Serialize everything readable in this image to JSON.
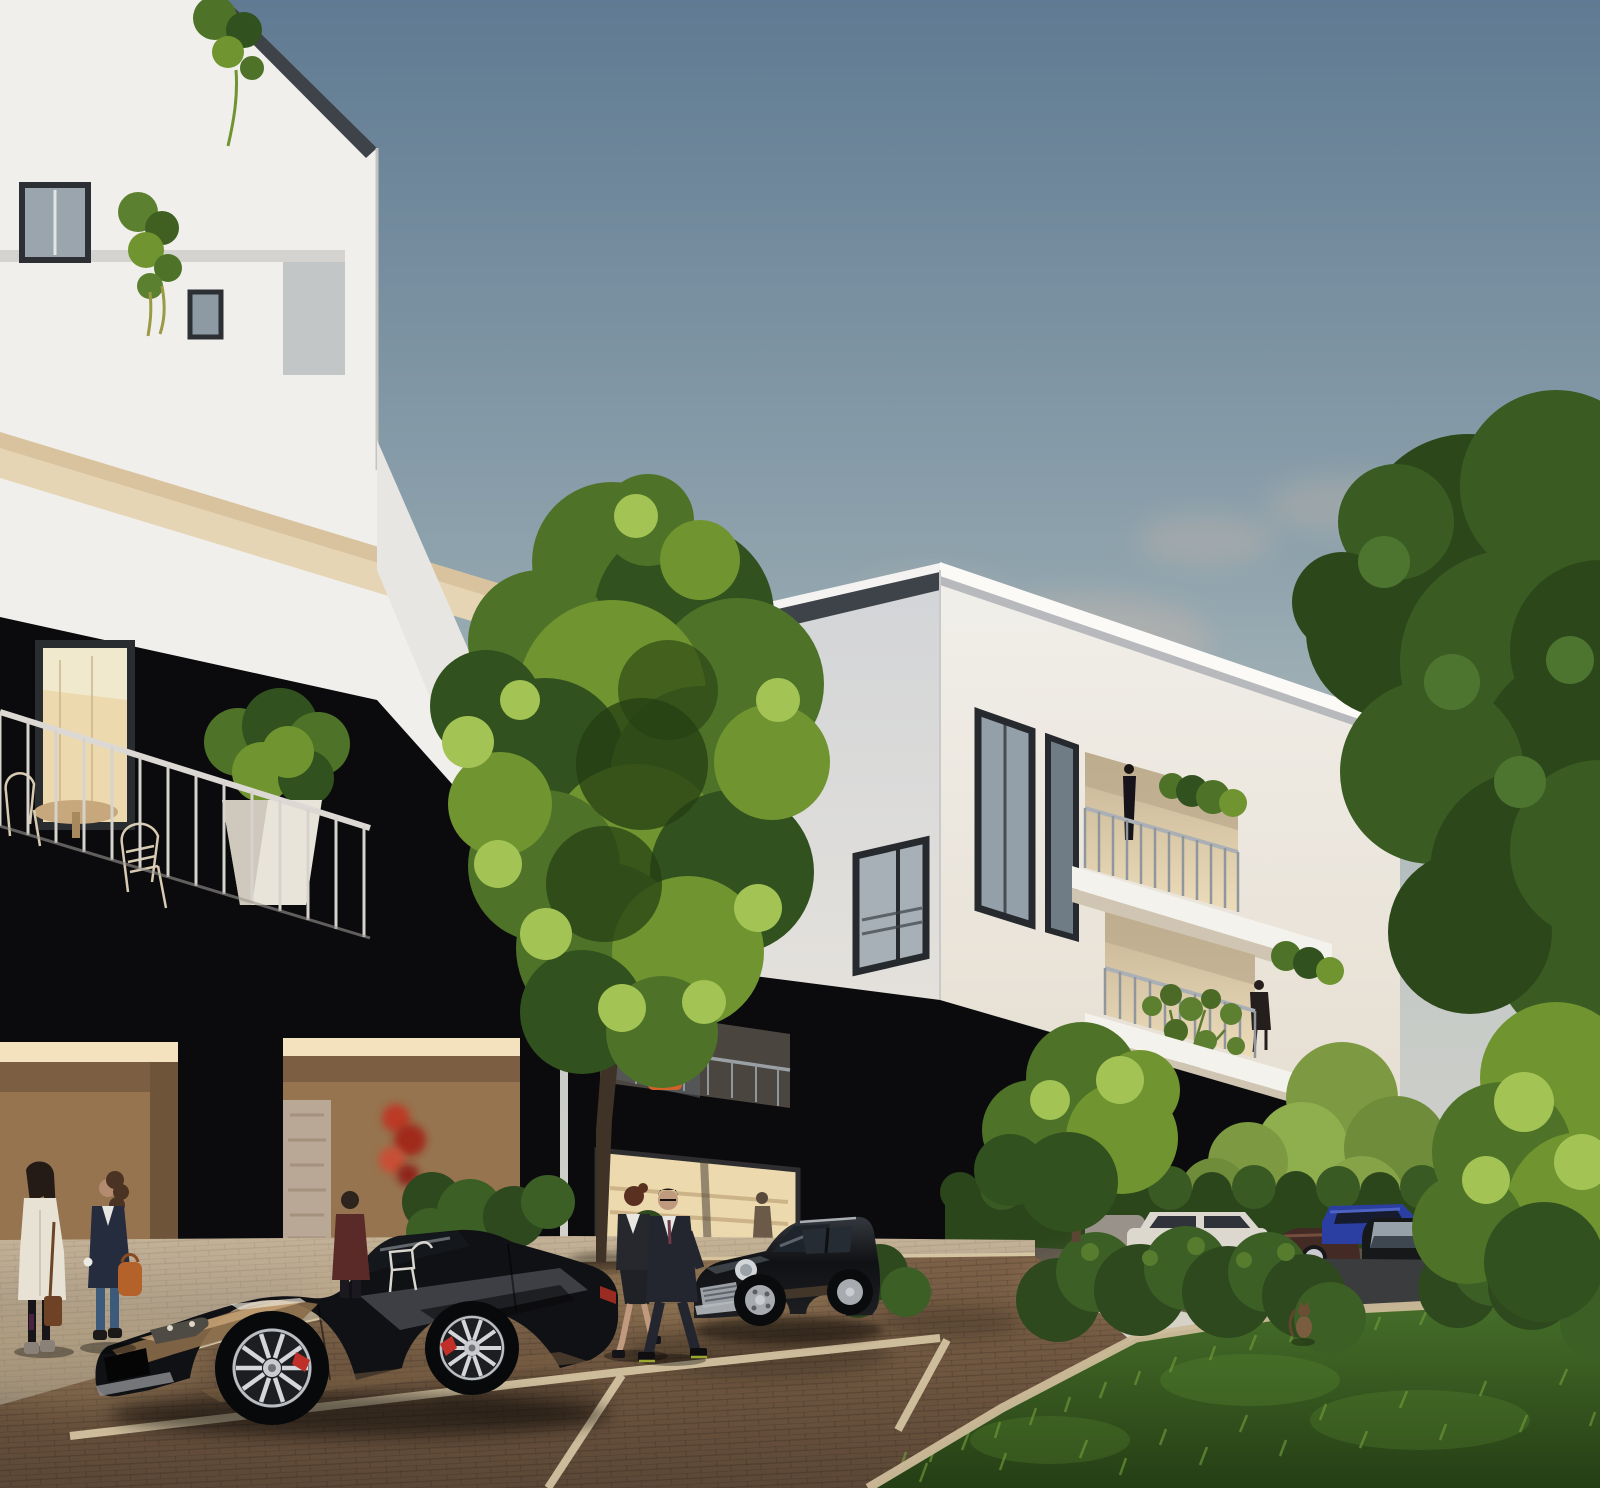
{
  "scene": {
    "title": "Architectural rendering of a modern black-and-white apartment complex at dusk, street view with parked cars, pedestrians, trees and warm-lit ground-floor shops",
    "time_of_day": "dusk",
    "style": "photorealistic CGI visualization"
  },
  "palette": {
    "sky_top": "#5f7a92",
    "sky_mid": "#8fa3ad",
    "sky_low": "#c7cbc7",
    "sky_horizon": "#ddd6cd",
    "cloud": "#cbb8ab",
    "facade_white": "#f0efec",
    "facade_white_shaded": "#d6d8da",
    "facade_black": "#0b0b0d",
    "roof_trim": "#3e434a",
    "soffit_cream": "#e6d5b4",
    "window_frame": "#26292d",
    "glass_cool": "#93a0a9",
    "glass_dark": "#2d343c",
    "interior_warm": "#ecd9ae",
    "portal_tan": "#96744f",
    "portal_tan_dark": "#6e5439",
    "accent_red_plant": "#c03524",
    "accent_orange_chair": "#d2622a",
    "railing_light": "#d6d3cd",
    "tree_dark": "#31511e",
    "tree_mid": "#4e7328",
    "tree_light": "#70942f",
    "tree_highlight": "#a3c355",
    "hedge": "#2c461c",
    "grass_dark": "#253e15",
    "grass_light": "#47702a",
    "road_brown": "#6e5640",
    "sidewalk": "#b3a38c",
    "marking_cream": "#d9c9a6",
    "asphalt": "#3a3c3d",
    "car_black": "#101114",
    "car_white": "#dcd8cf",
    "car_blue": "#2b3fa3",
    "car_maroon": "#432a24",
    "chrome": "#c9cbd0",
    "caliper_red": "#c03028",
    "skin": "#c09a7e",
    "coat_cream": "#e7e2d4",
    "jacket_navy": "#252c3e",
    "suit_dark": "#23252f",
    "jacket_maroon": "#5a2a28",
    "bag_orange": "#b5622a",
    "jeans_blue": "#3c5a7c",
    "cat_brown": "#7a5c3e"
  },
  "objects": [
    {
      "id": "building-left",
      "label": "white multi-storey apartment building in left foreground with black lower facade and recessed balconies"
    },
    {
      "id": "building-center",
      "label": "white corner apartment block with black ground floor and stacked corner balconies with planters"
    },
    {
      "id": "terrace-balcony",
      "label": "first-floor terrace with white railing, wire chairs, round table and potted shrub"
    },
    {
      "id": "entrance-portals",
      "label": "warm-lit recessed tan entrance portals with illuminated red plant"
    },
    {
      "id": "shop-window",
      "label": "warm-lit retail window with shelving and a browsing woman"
    },
    {
      "id": "tree-center",
      "label": "large plane tree in front of the buildings"
    },
    {
      "id": "trees-right",
      "label": "tall leafy trees framing the right edge"
    },
    {
      "id": "hedges",
      "label": "low clipped hedges along the parking area"
    },
    {
      "id": "grass",
      "label": "lawn in the right foreground"
    },
    {
      "id": "street",
      "label": "brick-paved street with cream parking-bay markings"
    },
    {
      "id": "sidewalk",
      "label": "paved walkway along the building entrances"
    },
    {
      "id": "car-sports",
      "label": "black chrome-finished sports car parked in the foreground"
    },
    {
      "id": "car-mini",
      "label": "black Mini hatchback parked at the kerb"
    },
    {
      "id": "car-white-sedan",
      "label": "white classic sedan in the background parking row"
    },
    {
      "id": "car-bronze",
      "label": "dark bronze coupe with chrome wheel in the background"
    },
    {
      "id": "car-blue",
      "label": "blue compact car in the background parking row"
    },
    {
      "id": "car-black-sedan",
      "label": "black sedan facing the viewer on the rear driveway"
    },
    {
      "id": "person-woman-cream",
      "label": "woman with long dark hair in cream coat chatting"
    },
    {
      "id": "person-woman-navy",
      "label": "woman in navy jacket with orange handbag holding a coffee cup"
    },
    {
      "id": "person-man-maroon",
      "label": "man in maroon blazer seen from behind near the entrance"
    },
    {
      "id": "person-couple",
      "label": "business couple in dark suits walking along the street"
    },
    {
      "id": "person-balcony",
      "label": "woman standing on the upper corner balcony"
    },
    {
      "id": "person-seated-balcony",
      "label": "resident seated at the middle balcony edge"
    },
    {
      "id": "cat",
      "label": "small brown cat sitting on the lawn"
    }
  ]
}
